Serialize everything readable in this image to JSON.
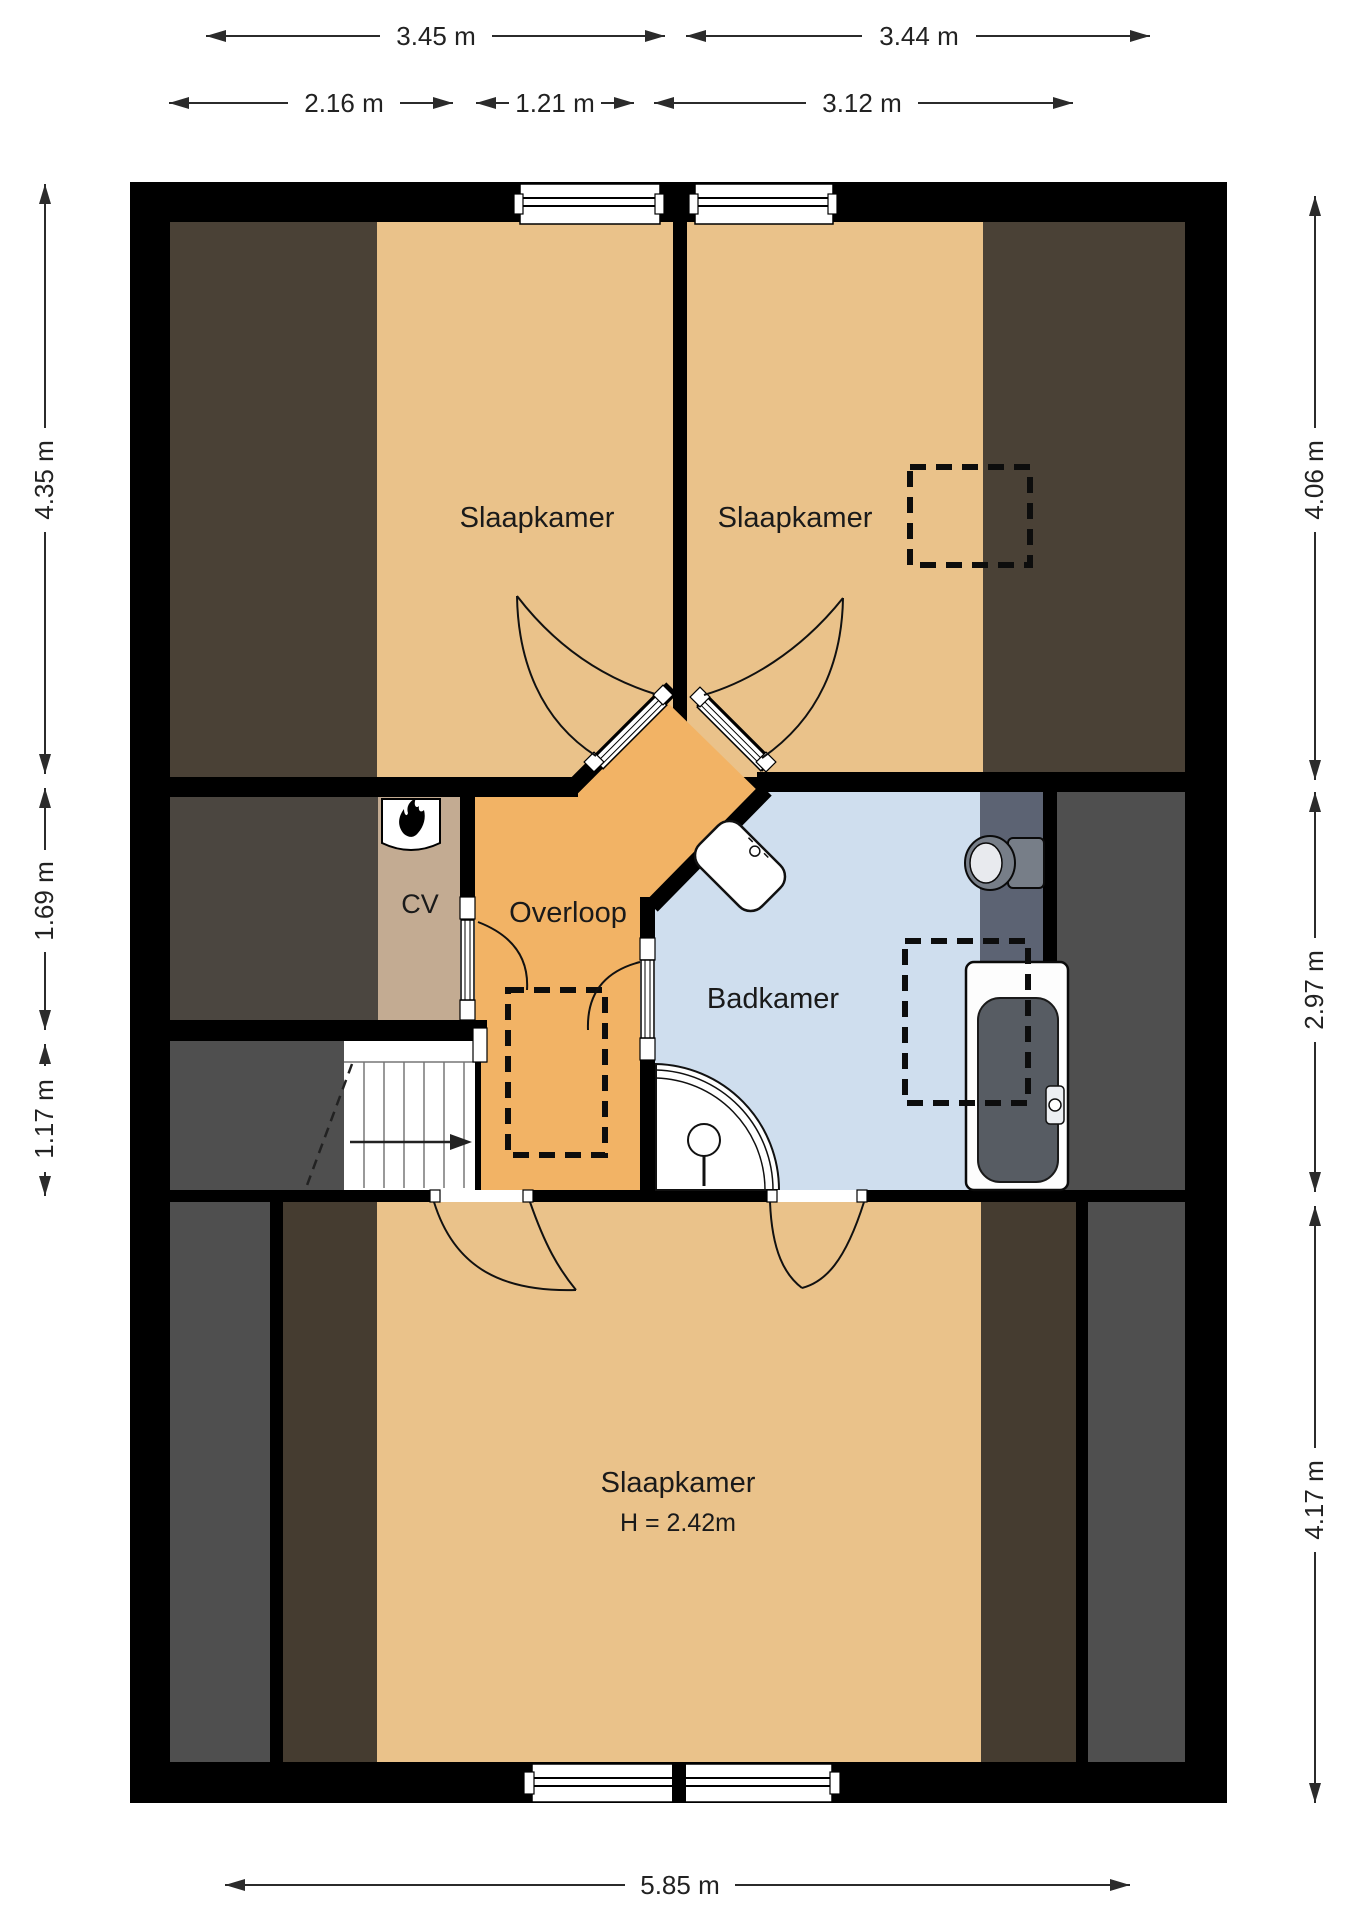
{
  "rooms": {
    "bedroom_top_left": {
      "label": "Slaapkamer"
    },
    "bedroom_top_right": {
      "label": "Slaapkamer"
    },
    "bedroom_bottom": {
      "label": "Slaapkamer",
      "height_note": "H = 2.42m"
    },
    "landing": {
      "label": "Overloop"
    },
    "bathroom": {
      "label": "Badkamer"
    },
    "heating_closet": {
      "label": "CV"
    }
  },
  "dimensions": {
    "top_outer_left": {
      "label": "3.45 m"
    },
    "top_outer_right": {
      "label": "3.44 m"
    },
    "top_inner_left": {
      "label": "2.16 m"
    },
    "top_inner_mid": {
      "label": "1.21 m"
    },
    "top_inner_right": {
      "label": "3.12 m"
    },
    "left_top": {
      "label": "4.35 m"
    },
    "left_mid": {
      "label": "1.69 m"
    },
    "left_bottom": {
      "label": "1.17 m"
    },
    "right_top": {
      "label": "4.06 m"
    },
    "right_mid": {
      "label": "2.97 m"
    },
    "right_bottom": {
      "label": "4.17 m"
    },
    "bottom": {
      "label": "5.85 m"
    }
  },
  "colors": {
    "wall": "#000000",
    "floor_tan": "#eac28a",
    "landing_orange": "#f2b365",
    "bathroom_blue": "#cfdeee",
    "bathroom_low": "#5c6373",
    "cv_beige": "#c3ab92",
    "attic_brown": "#4a4136",
    "attic_brown_dark": "#453c30",
    "void_grey": "#4f4f4f",
    "void_grey_warm": "#4b4640",
    "fixture_grey": "#777e88",
    "fixture_inner": "#e8eaee",
    "tub_inner": "#575c63",
    "white": "#ffffff"
  }
}
